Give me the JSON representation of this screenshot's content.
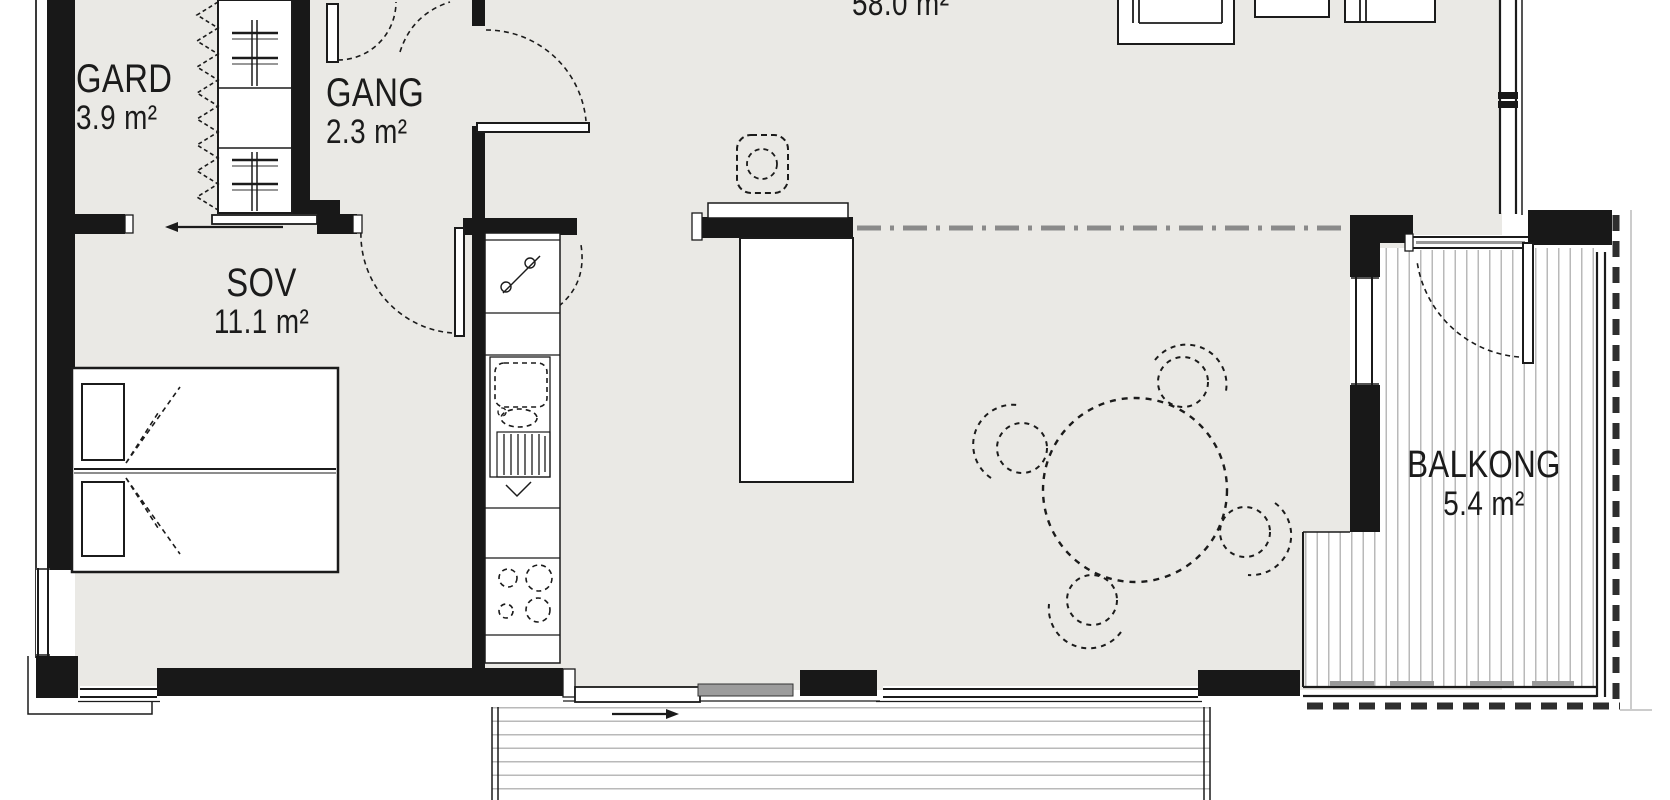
{
  "plan": {
    "rooms": {
      "gard": {
        "name": "GARD",
        "area": "3.9 m²"
      },
      "gang": {
        "name": "GANG",
        "area": "2.3 m²"
      },
      "sov": {
        "name": "SOV",
        "area": "11.1 m²"
      },
      "living": {
        "area": "58.0 m²"
      },
      "balkong": {
        "name": "BALKONG",
        "area": "5.4 m²"
      }
    },
    "colors": {
      "wall": "#181818",
      "floor": "#eae9e5",
      "line": "#1b1b1b",
      "deck_line": "#b9b9b9",
      "divider": "#8a8a8a",
      "door_panel": "#9c9c9c"
    }
  }
}
